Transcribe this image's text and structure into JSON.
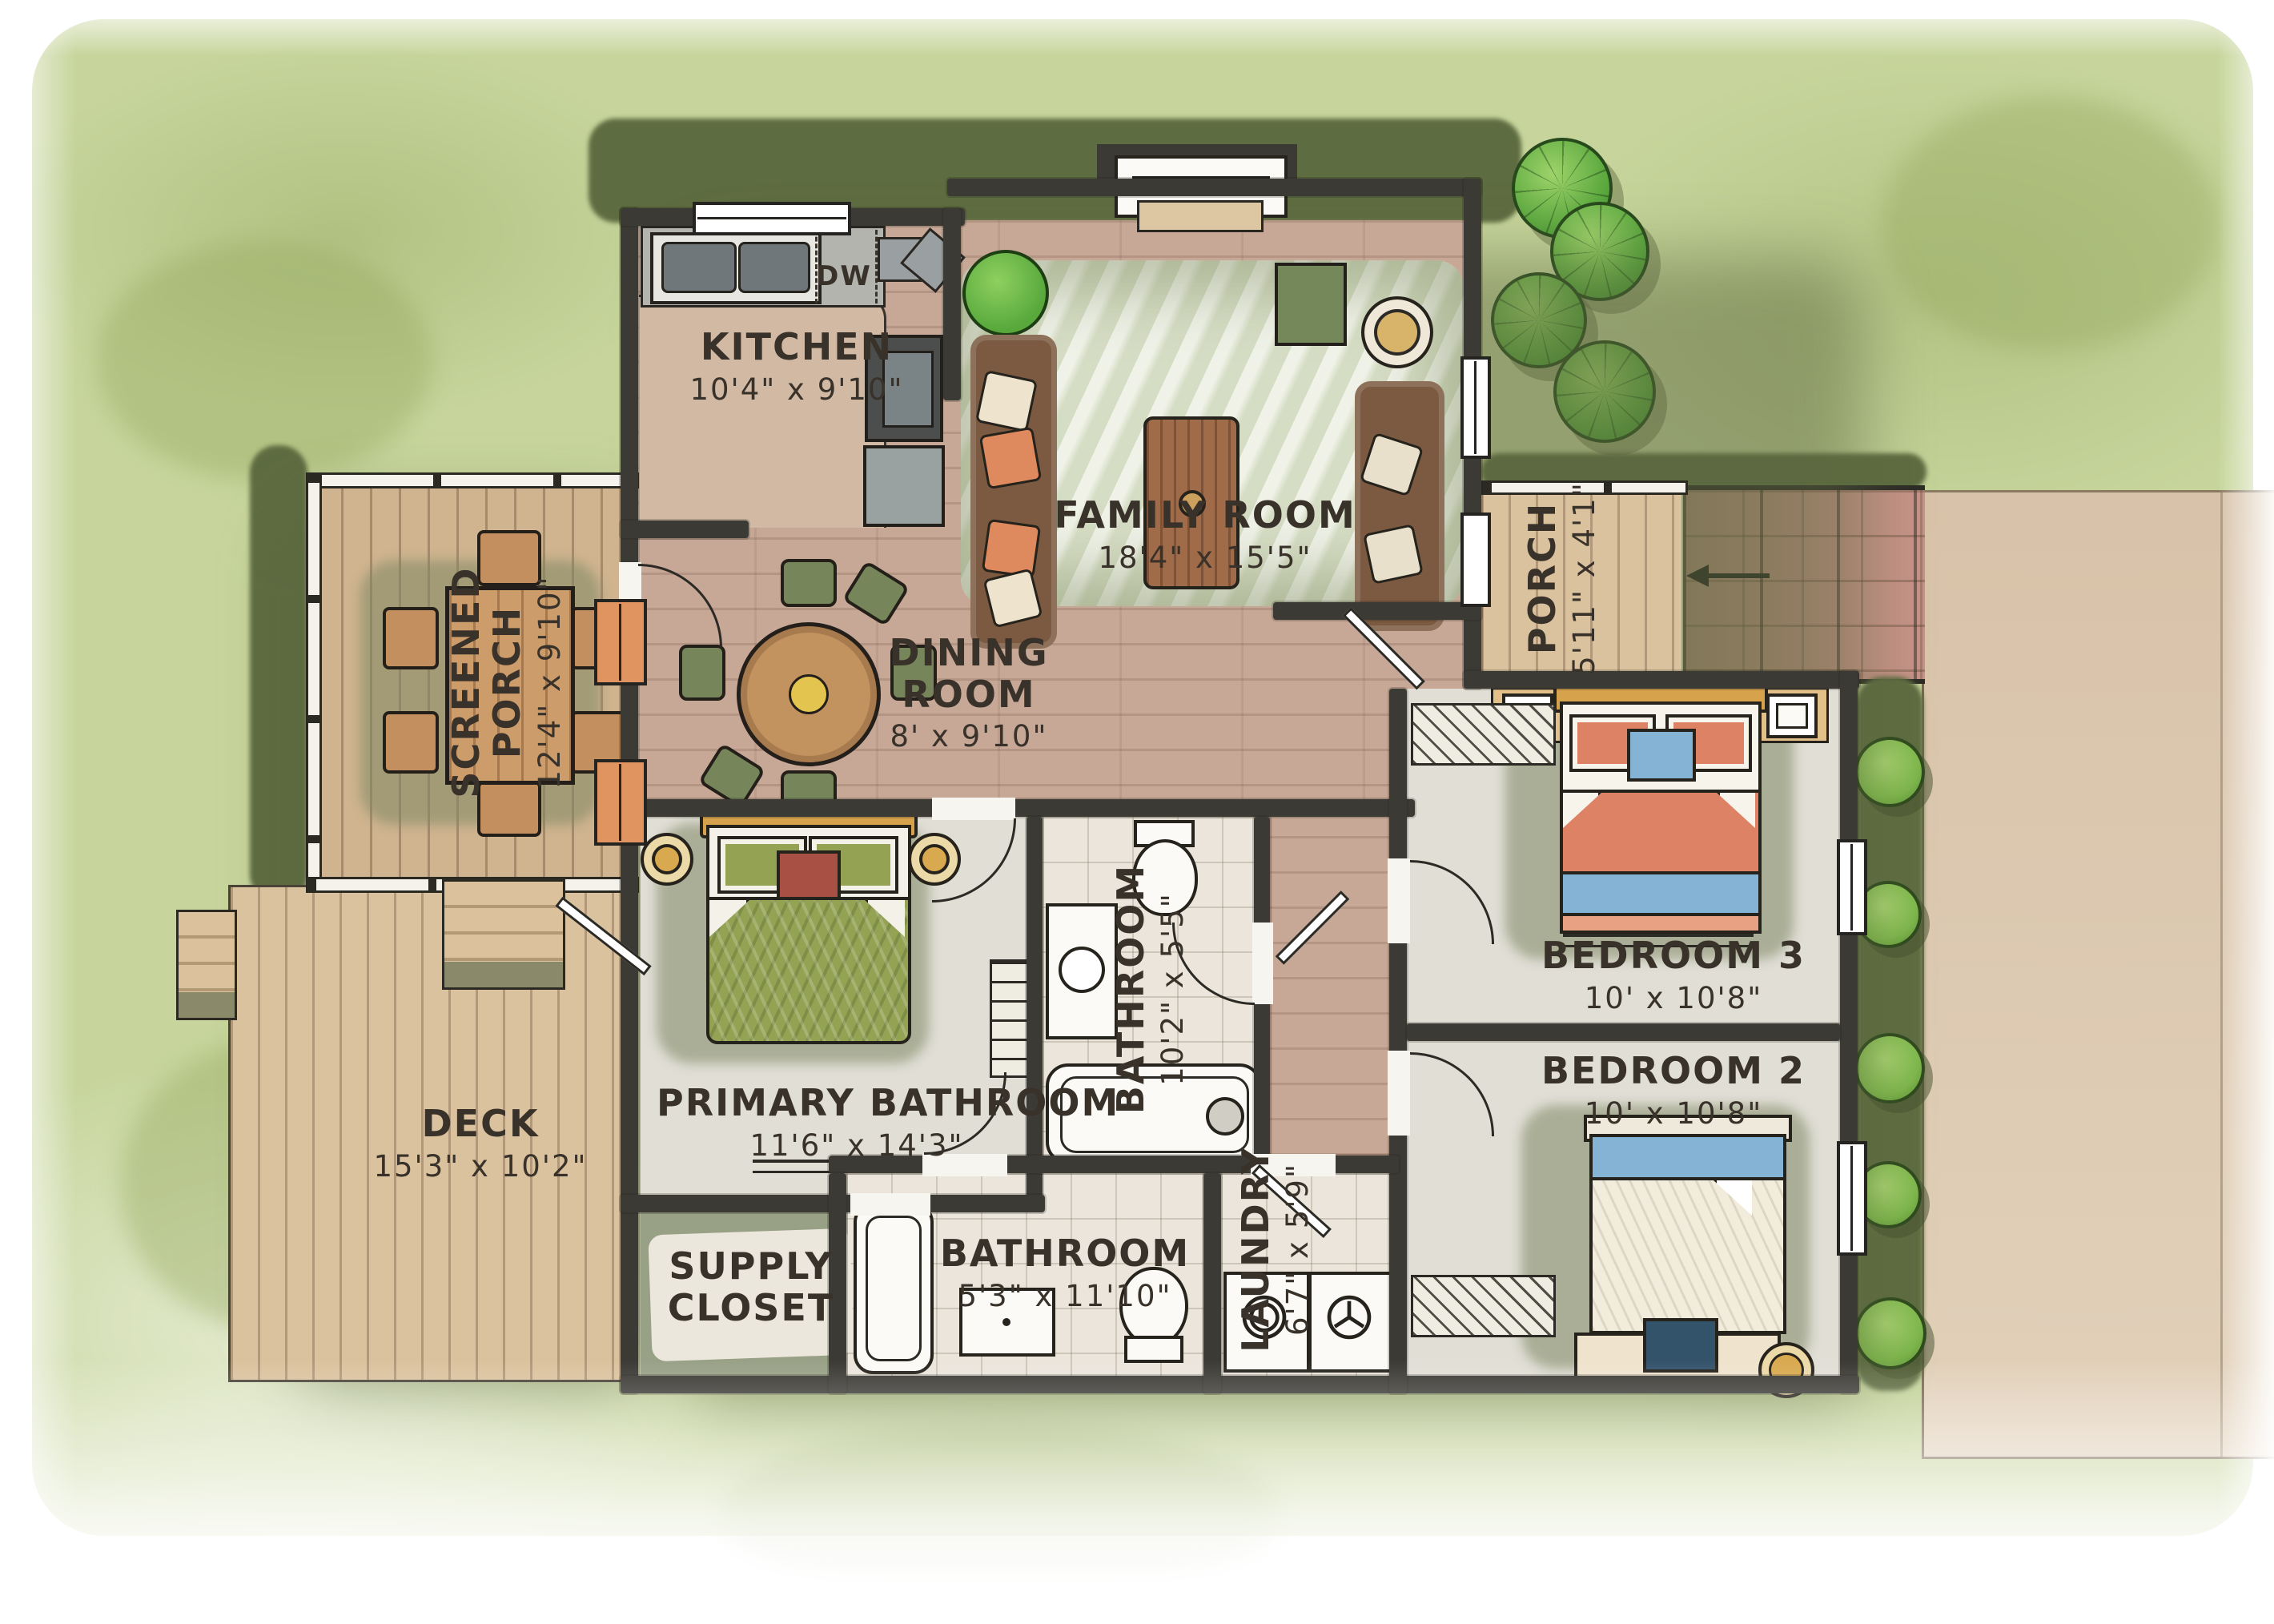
{
  "rooms": {
    "kitchen": {
      "name": "KITCHEN",
      "dims": "10'4\" x 9'10\""
    },
    "family_room": {
      "name": "FAMILY ROOM",
      "dims": "18'4\" x 15'5\""
    },
    "dining_room": {
      "name": "DINING ROOM",
      "dims": "8' x 9'10\""
    },
    "screened_porch": {
      "name": "SCREENED PORCH",
      "dims": "12'4\" x 9'10\""
    },
    "porch": {
      "name": "PORCH",
      "dims": "5'11\" x 4'1\""
    },
    "deck": {
      "name": "DECK",
      "dims": "15'3\" x 10'2\""
    },
    "primary_bedroom": {
      "name": "PRIMARY BATHROOM",
      "dims": "11'6\" x 14'3\""
    },
    "hall_bathroom": {
      "name": "BATHROOM",
      "dims": "10'2\" x 5'5\""
    },
    "main_bathroom": {
      "name": "BATHROOM",
      "dims": "5'3\" x 11'10\""
    },
    "laundry": {
      "name": "LAUNDRY",
      "dims": "6'7\" x 5'9\""
    },
    "bedroom_3": {
      "name": "BEDROOM 3",
      "dims": "10' x 10'8\""
    },
    "bedroom_2": {
      "name": "BEDROOM 2",
      "dims": "10' x 10'8\""
    },
    "supply_closet": {
      "name": "SUPPLY CLOSET",
      "dims": ""
    }
  },
  "annotations": {
    "dishwasher": "DW"
  },
  "colors": {
    "grass": "#c7d59c",
    "grass_shadow": "#5e6c41",
    "wall": "#3b3a35",
    "ink": "#39322a",
    "wood_floor": "#c7a897",
    "deck_wood": "#dbc29e",
    "tile": "#ebe5dc",
    "carpet": "#e0ded5",
    "marble": "#e1e6d2",
    "brick_path": "#c69387",
    "driveway": "#d8c2a9",
    "bed_green": "#93a253",
    "bed_coral": "#dd8264",
    "blanket_blue": "#85b3d6",
    "sofa_brown": "#7c5a41",
    "accent_orange": "#df8a5e",
    "tree_green": "#5aa83e"
  }
}
